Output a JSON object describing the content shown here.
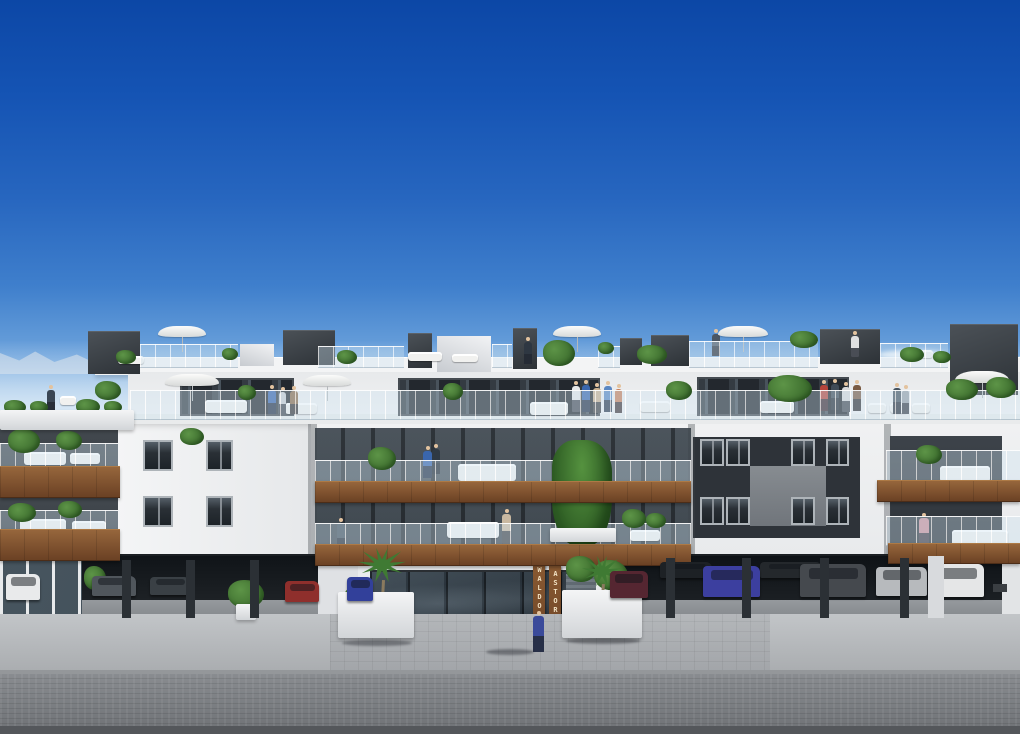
{
  "scene": {
    "signs": {
      "left": "WALDORF",
      "right": "ASTORIA"
    },
    "palette": {
      "sky_top": "#0c47a6",
      "sky_mid": "#3f7fcc",
      "sky_horizon": "#cfe2f2",
      "facade_white": "#f0f1f2",
      "facade_shadow": "#d8dbde",
      "dark_wall": "#3a4046",
      "recess_wall": "#2e3339",
      "glazing": "#23282e",
      "wood": "#7c4e2c",
      "glass_rail": "#cde2f0",
      "plant_green": "#3e6f2f",
      "umbrella_white": "#f4f4f2",
      "sidewalk": "#b4b7ba",
      "street": "#7e8184",
      "garage_interior": "#14181c"
    }
  },
  "elements": {
    "white-box": [
      [
        437,
        336,
        54,
        36
      ],
      [
        240,
        344,
        34,
        22
      ]
    ],
    "roof-box": [
      [
        88,
        331,
        52,
        42
      ],
      [
        283,
        330,
        52,
        34
      ],
      [
        408,
        333,
        24,
        34
      ],
      [
        513,
        328,
        24,
        40
      ],
      [
        620,
        338,
        22,
        26
      ],
      [
        651,
        335,
        38,
        30
      ],
      [
        820,
        329,
        60,
        34
      ],
      [
        950,
        324,
        68,
        70
      ]
    ],
    "dark-section": [
      [
        180,
        378,
        114,
        38
      ],
      [
        398,
        378,
        202,
        38
      ],
      [
        697,
        377,
        152,
        39
      ]
    ],
    "wall-patch": [
      [
        750,
        466,
        76,
        60
      ]
    ],
    "window": [
      [
        143,
        440,
        30,
        31
      ],
      [
        206,
        440,
        27,
        31
      ],
      [
        143,
        496,
        30,
        31
      ],
      [
        206,
        496,
        27,
        31
      ],
      [
        700,
        439,
        24,
        27
      ],
      [
        726,
        439,
        24,
        27
      ],
      [
        791,
        439,
        24,
        27
      ],
      [
        826,
        439,
        23,
        27
      ],
      [
        700,
        497,
        24,
        28
      ],
      [
        726,
        497,
        24,
        28
      ],
      [
        791,
        497,
        24,
        28
      ],
      [
        826,
        497,
        23,
        28
      ]
    ],
    "sofa": [
      [
        60,
        396,
        16,
        9
      ],
      [
        118,
        356,
        26,
        8
      ],
      [
        408,
        352,
        34,
        9
      ],
      [
        452,
        354,
        26,
        8
      ],
      [
        905,
        350,
        28,
        8
      ],
      [
        205,
        400,
        42,
        13
      ],
      [
        285,
        403,
        32,
        11
      ],
      [
        530,
        402,
        38,
        13
      ],
      [
        640,
        401,
        30,
        11
      ],
      [
        760,
        401,
        34,
        12
      ],
      [
        868,
        403,
        18,
        10
      ],
      [
        890,
        403,
        18,
        10
      ],
      [
        912,
        403,
        18,
        10
      ],
      [
        24,
        452,
        42,
        13
      ],
      [
        70,
        453,
        30,
        11
      ],
      [
        458,
        464,
        58,
        17
      ],
      [
        940,
        466,
        50,
        16
      ],
      [
        20,
        519,
        46,
        13
      ],
      [
        72,
        521,
        34,
        11
      ],
      [
        447,
        522,
        52,
        16
      ],
      [
        630,
        530,
        30,
        11
      ],
      [
        952,
        530,
        56,
        16
      ]
    ],
    "person": [
      [
        47,
        390,
        8,
        22,
        "#3a4654"
      ],
      [
        524,
        342,
        8,
        22,
        "#2e3742"
      ],
      [
        712,
        334,
        8,
        22,
        "#4a5664"
      ],
      [
        851,
        336,
        8,
        21,
        "#dfe0e1"
      ],
      [
        268,
        390,
        8,
        24,
        "#3a66ad"
      ],
      [
        279,
        392,
        7,
        22,
        "#c8ccd0"
      ],
      [
        290,
        391,
        8,
        23,
        "#8a6a4a"
      ],
      [
        572,
        386,
        8,
        26,
        "#e6e7e8"
      ],
      [
        582,
        385,
        8,
        27,
        "#3a66ad"
      ],
      [
        593,
        388,
        8,
        25,
        "#c9b08f"
      ],
      [
        604,
        386,
        8,
        26,
        "#5b87c2"
      ],
      [
        615,
        389,
        7,
        24,
        "#c87f5a"
      ],
      [
        820,
        385,
        8,
        26,
        "#b5443a"
      ],
      [
        831,
        384,
        8,
        26,
        "#3f4a56"
      ],
      [
        842,
        387,
        8,
        25,
        "#d8d9da"
      ],
      [
        853,
        385,
        8,
        26,
        "#7a5b43"
      ],
      [
        893,
        388,
        8,
        26,
        "#46525e"
      ],
      [
        902,
        390,
        7,
        24,
        "#9aa2a9"
      ],
      [
        423,
        451,
        9,
        27,
        "#3a66ad"
      ],
      [
        432,
        449,
        8,
        25,
        "#2f3944"
      ],
      [
        337,
        523,
        8,
        28,
        "#46525e"
      ],
      [
        502,
        514,
        9,
        30,
        "#c9b8a0"
      ],
      [
        919,
        518,
        10,
        28,
        "#c98f9a"
      ],
      [
        533,
        616,
        11,
        36,
        "#3a4a9a"
      ]
    ],
    "umbrella": [
      [
        158,
        326,
        48,
        11
      ],
      [
        553,
        326,
        48,
        11
      ],
      [
        718,
        326,
        50,
        11
      ],
      [
        165,
        374,
        54,
        12
      ],
      [
        303,
        375,
        48,
        11
      ],
      [
        955,
        371,
        54,
        12
      ]
    ],
    "glass-rail": [
      [
        140,
        344,
        98,
        22
      ],
      [
        318,
        346,
        86,
        20
      ],
      [
        492,
        344,
        20,
        22
      ],
      [
        598,
        346,
        22,
        20
      ],
      [
        689,
        341,
        129,
        25
      ],
      [
        880,
        343,
        68,
        23
      ],
      [
        130,
        390,
        890,
        28
      ],
      [
        0,
        443,
        118,
        25
      ],
      [
        0,
        510,
        118,
        24
      ],
      [
        315,
        460,
        376,
        23
      ],
      [
        315,
        523,
        376,
        22
      ],
      [
        886,
        450,
        134,
        32
      ],
      [
        886,
        516,
        134,
        28
      ]
    ],
    "tree": [
      [
        552,
        440,
        60,
        106
      ]
    ],
    "wood-band": [
      [
        0,
        466,
        120,
        30
      ],
      [
        0,
        529,
        120,
        30
      ],
      [
        315,
        481,
        376,
        20
      ],
      [
        315,
        544,
        376,
        20
      ],
      [
        877,
        480,
        143,
        20
      ],
      [
        888,
        543,
        132,
        19
      ]
    ],
    "plant": [
      [
        116,
        350,
        20,
        14
      ],
      [
        222,
        348,
        16,
        12
      ],
      [
        337,
        350,
        20,
        14
      ],
      [
        543,
        340,
        32,
        26
      ],
      [
        598,
        342,
        16,
        12
      ],
      [
        637,
        345,
        30,
        19
      ],
      [
        790,
        331,
        28,
        17
      ],
      [
        900,
        347,
        24,
        15
      ],
      [
        933,
        351,
        18,
        12
      ],
      [
        4,
        400,
        22,
        14
      ],
      [
        30,
        401,
        18,
        12
      ],
      [
        76,
        399,
        24,
        15
      ],
      [
        104,
        401,
        18,
        12
      ],
      [
        95,
        381,
        26,
        19
      ],
      [
        238,
        385,
        18,
        15
      ],
      [
        443,
        383,
        20,
        17
      ],
      [
        666,
        381,
        26,
        19
      ],
      [
        768,
        375,
        44,
        27
      ],
      [
        946,
        379,
        32,
        21
      ],
      [
        986,
        377,
        30,
        21
      ],
      [
        8,
        429,
        32,
        24
      ],
      [
        56,
        431,
        26,
        19
      ],
      [
        180,
        428,
        24,
        17
      ],
      [
        8,
        503,
        28,
        19
      ],
      [
        58,
        501,
        24,
        17
      ],
      [
        368,
        447,
        28,
        23
      ],
      [
        622,
        509,
        24,
        19
      ],
      [
        646,
        513,
        20,
        15
      ],
      [
        916,
        445,
        26,
        19
      ],
      [
        84,
        566,
        22,
        24
      ],
      [
        228,
        580,
        36,
        28
      ],
      [
        566,
        556,
        30,
        26
      ],
      [
        594,
        560,
        34,
        30
      ],
      [
        344,
        586,
        30,
        24
      ]
    ],
    "palm": [
      [
        358,
        548,
        48,
        70
      ],
      [
        582,
        556,
        40,
        62
      ]
    ],
    "shadow": [
      [
        486,
        649,
        48,
        6
      ],
      [
        342,
        640,
        70,
        6
      ],
      [
        566,
        638,
        74,
        6
      ]
    ],
    "planter": [
      [
        0,
        410,
        134,
        20
      ],
      [
        550,
        528,
        66,
        14
      ],
      [
        338,
        592,
        76,
        46
      ],
      [
        562,
        590,
        80,
        48
      ],
      [
        236,
        604,
        20,
        16
      ]
    ],
    "car": [
      [
        6,
        574,
        34,
        26,
        "#e9eaeb"
      ],
      [
        92,
        576,
        44,
        20,
        "#50565c"
      ],
      [
        150,
        577,
        40,
        18,
        "#3a4045"
      ],
      [
        285,
        581,
        34,
        21,
        "#8f2f2c"
      ],
      [
        347,
        577,
        26,
        24,
        "#32409a"
      ],
      [
        610,
        571,
        38,
        27,
        "#552631"
      ],
      [
        660,
        562,
        52,
        16,
        "#1d2125"
      ],
      [
        760,
        562,
        62,
        16,
        "#24282c"
      ],
      [
        703,
        566,
        57,
        31,
        "#3c3f9f"
      ],
      [
        800,
        564,
        66,
        33,
        "#45494e"
      ],
      [
        876,
        567,
        51,
        29,
        "#b7babd"
      ],
      [
        928,
        564,
        56,
        33,
        "#e5e6e7"
      ]
    ],
    "pillar": [
      [
        122,
        560,
        9,
        58
      ],
      [
        186,
        560,
        9,
        58
      ],
      [
        250,
        560,
        9,
        58
      ],
      [
        666,
        558,
        9,
        60
      ],
      [
        742,
        558,
        9,
        60
      ],
      [
        820,
        558,
        9,
        60
      ],
      [
        900,
        558,
        9,
        60
      ],
      [
        928,
        556,
        16,
        62,
        "#d8dadd"
      ]
    ]
  }
}
